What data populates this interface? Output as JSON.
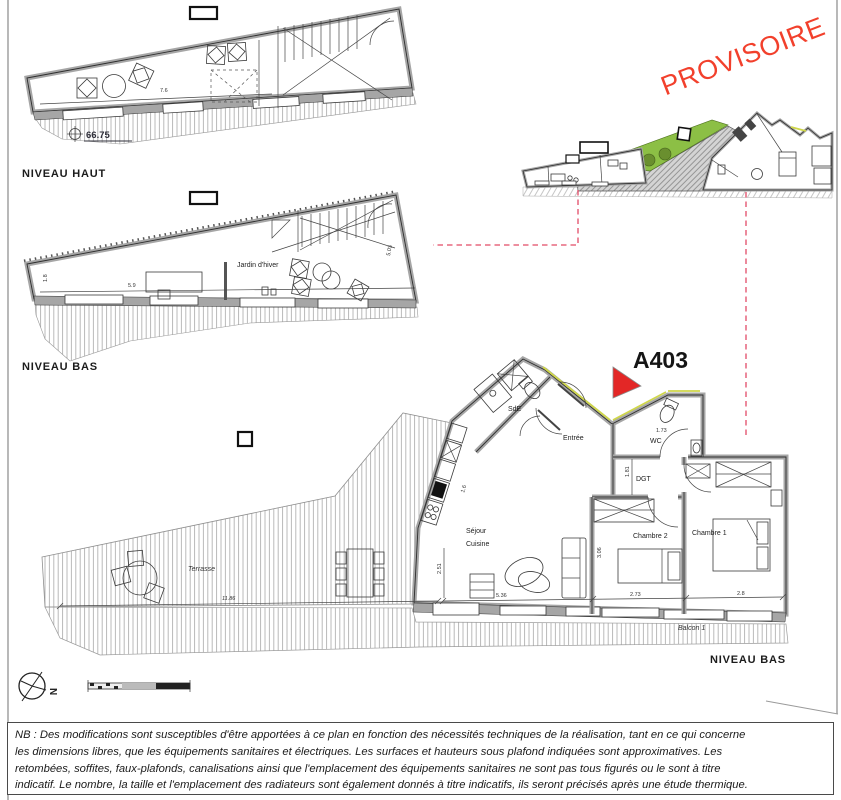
{
  "page": {
    "stamp": "PROVISOIRE",
    "apartment_id": "A403",
    "north_label": "N"
  },
  "plan_upper": {
    "title": "NIVEAU HAUT",
    "level_mark": "66.75",
    "dim_width": "7.6"
  },
  "plan_lower": {
    "title": "NIVEAU BAS",
    "room_jardin": "Jardin d'hiver",
    "dim_width": "5.9",
    "dim_left": "1.8",
    "dim_right": "5.03"
  },
  "plan_main": {
    "title": "NIVEAU BAS",
    "rooms": {
      "sde": "SdE",
      "entree": "Entrée",
      "wc": "WC",
      "dgt": "DGT",
      "sejour_line1": "Séjour",
      "sejour_line2": "Cuisine",
      "chambre2": "Chambre 2",
      "chambre1": "Chambre 1",
      "balcon": "Balcon 1",
      "terrasse": "Terrasse"
    },
    "dims": {
      "sejour_w": "5.36",
      "chambre2_w": "2.73",
      "chambre1_w": "2.8",
      "sejour_h": "2.51",
      "kitchen": "1.6",
      "dgt_h": "1.81",
      "wc_w": "1.73",
      "chambre2_h": "3.06",
      "terrasse_w": "11.86"
    }
  },
  "notes": {
    "line1": "NB : Des modifications sont susceptibles d'être apportées à ce plan en fonction des nécessités techniques de la réalisation,  tant en ce qui concerne",
    "line2": "les dimensions libres, que les équipements sanitaires et électriques. Les surfaces et hauteurs sous plafond indiquées sont approximatives. Les",
    "line3": "retombées, soffites, faux-plafonds, canalisations ainsi que l'emplacement des équipements sanitaires ne sont pas tous figurés ou le sont à titre",
    "line4": "indicatif. Le nombre, la taille et l'emplacement des radiateurs sont également donnés à titre indicatifs, ils seront précisés après une étude thermique."
  },
  "colors": {
    "stamp_red": "#f2402c",
    "triangle_red": "#e32726",
    "leader_pink": "#e24a66",
    "roof_green": "#8cbf45",
    "wall_gray": "#a6a6a6",
    "accent_yellow": "#cfd64a"
  }
}
